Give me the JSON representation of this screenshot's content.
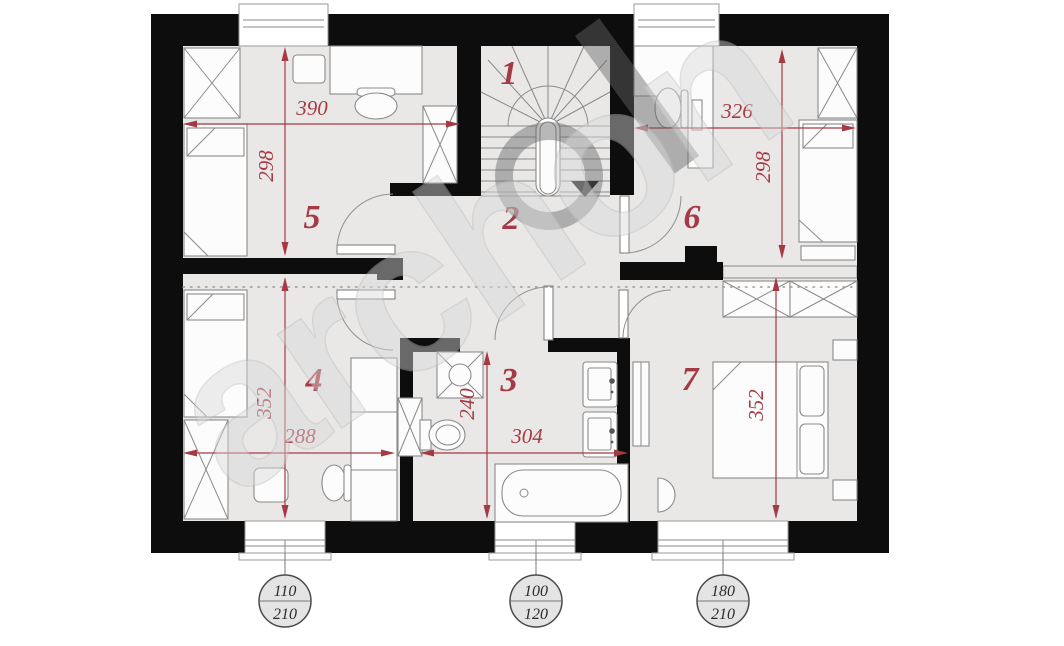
{
  "plan": {
    "watermark": {
      "text": "archon"
    },
    "rooms": [
      {
        "number": "1"
      },
      {
        "number": "2"
      },
      {
        "number": "3"
      },
      {
        "number": "4"
      },
      {
        "number": "5"
      },
      {
        "number": "6"
      },
      {
        "number": "7"
      }
    ],
    "dimensions": [
      {
        "id": "room5-width",
        "value": "390"
      },
      {
        "id": "room5-height",
        "value": "298"
      },
      {
        "id": "room6-width",
        "value": "326"
      },
      {
        "id": "room6-height",
        "value": "298"
      },
      {
        "id": "room4-height",
        "value": "352"
      },
      {
        "id": "room4-width",
        "value": "288"
      },
      {
        "id": "bathroom-height",
        "value": "240"
      },
      {
        "id": "bathroom-width",
        "value": "304"
      },
      {
        "id": "room7-height",
        "value": "352"
      }
    ],
    "window_tags": [
      {
        "top": "110",
        "bottom": "210"
      },
      {
        "top": "100",
        "bottom": "120"
      },
      {
        "top": "180",
        "bottom": "210"
      }
    ],
    "colors": {
      "wall": "#0d0d0d",
      "floor": "#e9e8e7",
      "annotation_red": "#a63a44",
      "watermark_gray": "#cfcfcf"
    }
  }
}
